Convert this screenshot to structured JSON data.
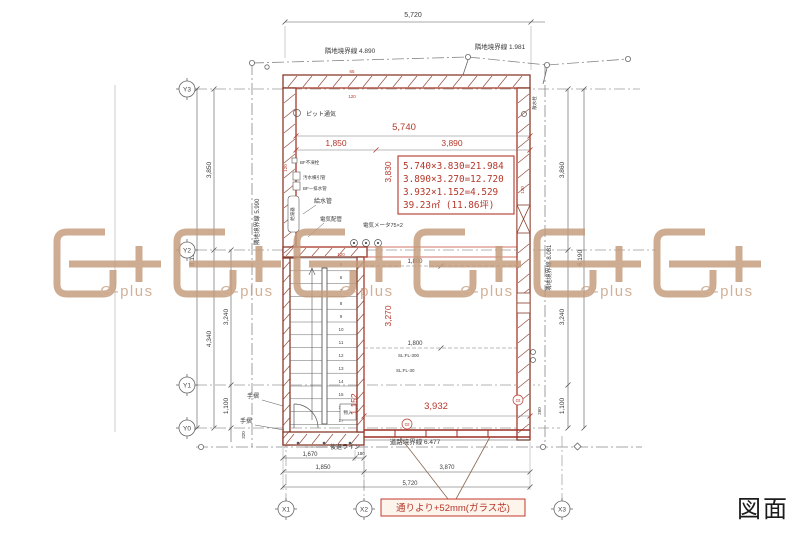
{
  "page": {
    "label": "図面"
  },
  "watermark": {
    "text": "G-plus"
  },
  "axes": {
    "y": [
      "Y3",
      "Y2",
      "Y1",
      "Y0"
    ],
    "x": [
      "X1",
      "X2",
      "X3"
    ]
  },
  "boundaries": {
    "top": "隣地境界線 4.890",
    "top_right": "隣地境界線 1.981",
    "left": "隣地境界線 5.990",
    "right": "隣地境界線 8.081",
    "bottom": "道路境界線 6.477"
  },
  "area_calc": {
    "line1": "5.740×3.830=21.984",
    "line2": "3.890×3.270=12.720",
    "line3": "3.932×1.152=4.529",
    "line4": "39.23㎡ (11.86坪)"
  },
  "note": {
    "text": "通りより+52mm(ガラス芯)"
  },
  "dims": {
    "red": {
      "w_total": "5,740",
      "w_left": "1,850",
      "w_right": "3,890",
      "d_upper": "3,830",
      "d_stair": "3,270",
      "d_entry": "1,152",
      "w_bottom": "3,932"
    },
    "top": {
      "overall": "5,720"
    },
    "bottom": {
      "seg1": "1,670",
      "seg2": "180",
      "seg3": "1,850",
      "seg4": "3,870",
      "overall": "5,720"
    },
    "left": {
      "overall": "8,190",
      "upper": "3,850",
      "lower": "4,340",
      "mid": "3,240",
      "low": "1,100",
      "step": "320"
    },
    "right": {
      "overall": "6,190",
      "upper": "3,860",
      "mid": "3,240",
      "low": "1,100",
      "small": "260"
    },
    "interior": {
      "w1": "1,800",
      "w2": "1,800"
    },
    "wall": {
      "t65": "65",
      "t120": "120"
    }
  },
  "labels": {
    "pit_vent": "ピット通気",
    "bf_valve": "BF不凍栓",
    "sewage_pipe": "汚水横引管",
    "bf_drain": "BFー排水管",
    "water_heater": "給湯器",
    "water_supply": "給水管",
    "electric_conduit": "電気配管",
    "electric_meter": "電気メータ75×2",
    "sprinkler": "散水栓",
    "handrail": "手摺",
    "setback_line": "後退ライン",
    "storage": "物入",
    "sl_fl_300": "SL:FL-300",
    "sl_fl_30": "SL:FL-30",
    "glass_mark": "Gt"
  },
  "stair": {
    "numbers": [
      "5",
      "6",
      "7",
      "8",
      "9",
      "10",
      "11",
      "12",
      "13",
      "14",
      "15",
      "16",
      "17"
    ]
  }
}
